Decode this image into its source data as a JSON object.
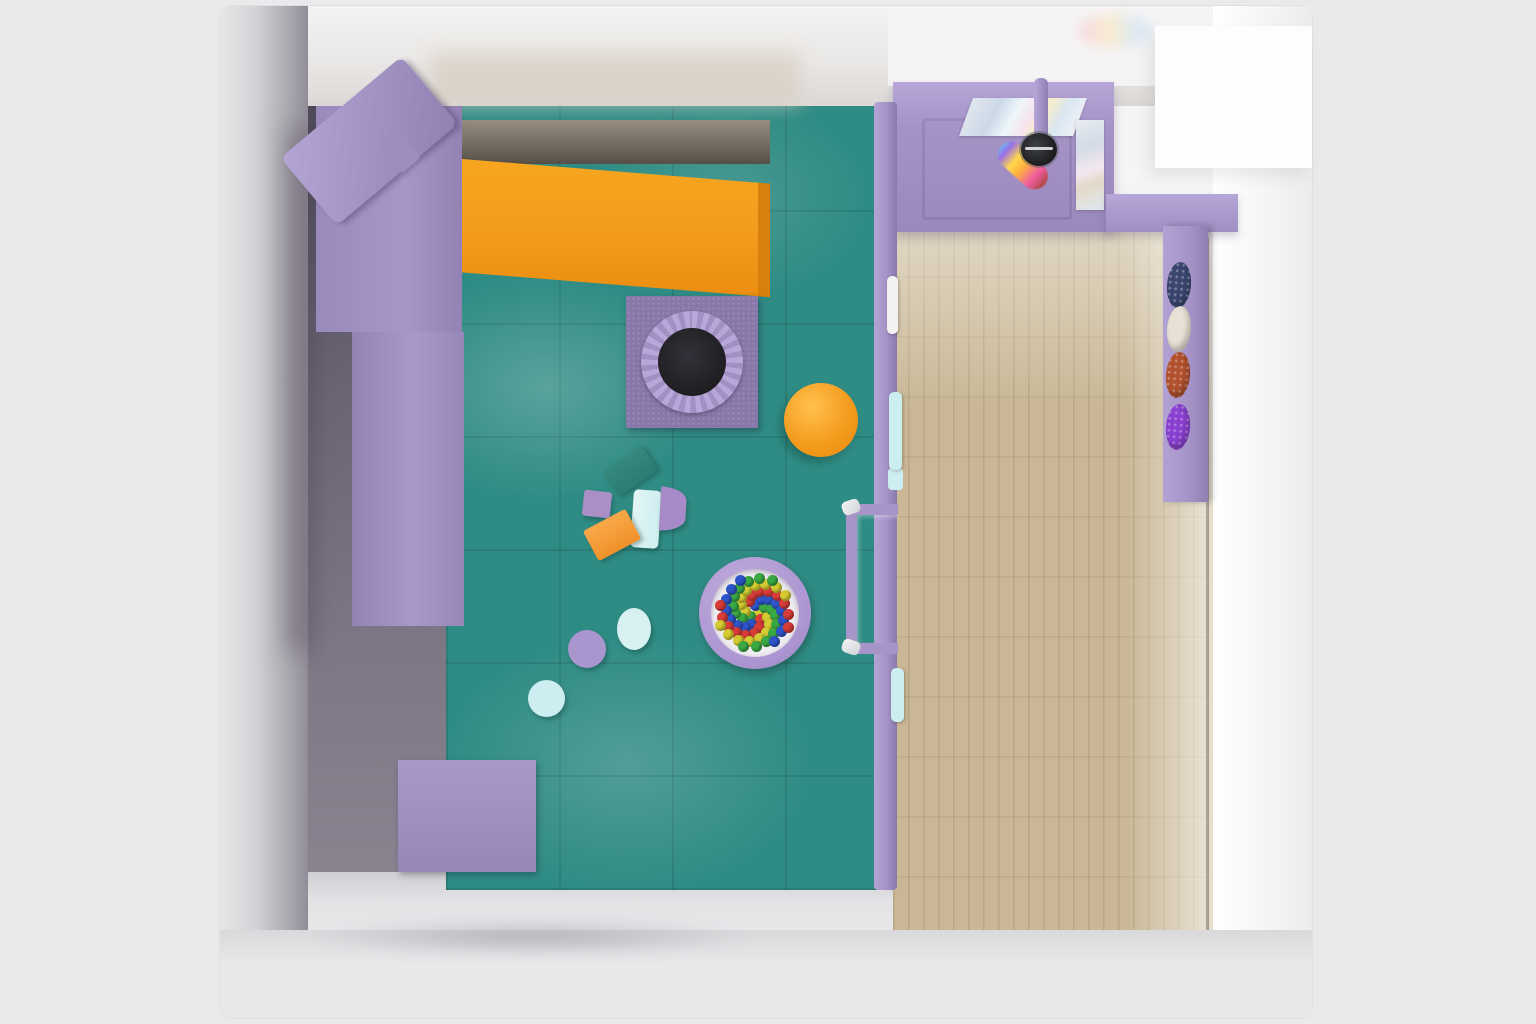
{
  "scene": {
    "type": "3d-render-top-view",
    "subject": "indoor kids soft-play playground room with cafe corner"
  },
  "palette": {
    "bg": "#eaeaec",
    "teal": "#2f8c84",
    "lav": "#a593c7",
    "lav_light": "#b7a6d8",
    "lav_dark": "#8f7eb2",
    "orange": "#f49c1e",
    "orange_dark": "#d97f0c",
    "yellow": "#ffd21f",
    "red": "#d23b34",
    "lblue": "#cdeef0",
    "wood": "#c9b795",
    "black_mesh": "#1d1c1f",
    "white": "#fdfdfd",
    "navy": "#3b4670",
    "cream": "#e8e2d6",
    "rust": "#b2512d",
    "violet": "#8a3fd0"
  },
  "ball_pit": {
    "ball_count": 66,
    "ball_colors": [
      "#d63c38",
      "#2e54c9",
      "#3aa843",
      "#d3cb31"
    ]
  },
  "climb_panel": {
    "hold_count": 15,
    "hold_color": "#f49c1e"
  },
  "counts": {
    "cafe_tables": 2,
    "chairs_per_table": 4,
    "bench_cushions": 4,
    "roller_ramp_stripes": 8,
    "stepping_stones": 3
  },
  "inventory": [
    "purple play frame",
    "orange wave slide",
    "square trampoline with round mesh",
    "round ball pit with colored balls",
    "orange pouf",
    "soft foam blocks",
    "climbing panel with orange holds",
    "transparent bubble dome",
    "red punching ball",
    "roller ramp with purple and blue rollers",
    "foam cylinders",
    "purple wedge blocks",
    "white safety rails",
    "reception desk with rainbow projector",
    "wall bench with leaf cushions",
    "two cafe tables with four chairs each",
    "white shoe bench",
    "wood plank cafe floor",
    "teal padded play floor"
  ]
}
